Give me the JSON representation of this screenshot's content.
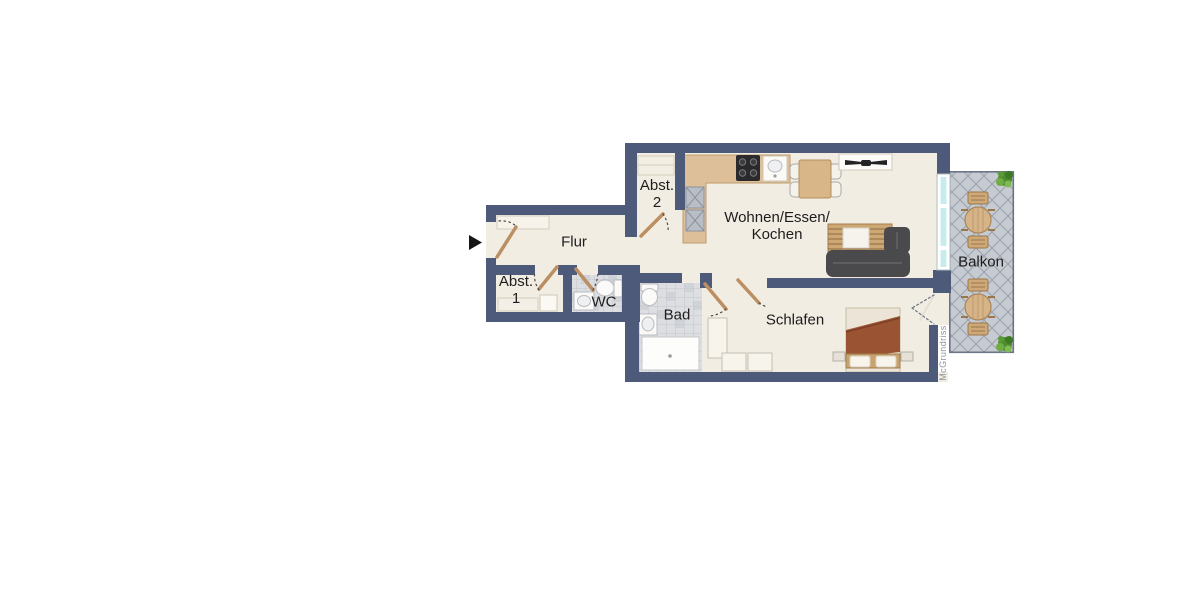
{
  "plan": {
    "rooms": {
      "flur": {
        "label": "Flur"
      },
      "abst1": {
        "label_line1": "Abst.",
        "label_line2": "1"
      },
      "abst2": {
        "label_line1": "Abst.",
        "label_line2": "2"
      },
      "wc": {
        "label": "WC"
      },
      "bad": {
        "label": "Bad"
      },
      "wohnen": {
        "label_line1": "Wohnen/Essen/",
        "label_line2": "Kochen"
      },
      "schlafen": {
        "label": "Schlafen"
      },
      "balkon": {
        "label": "Balkon"
      }
    },
    "watermark": "McGrundriss",
    "colors": {
      "wall": "#4d5a7a",
      "floor": "#f2ede3",
      "tile": "#dcdee1",
      "balcony_tile": "#c6cad1",
      "counter": "#ddbf9a",
      "door_leaf": "#bb8f62",
      "window_glass": "#c8ecee",
      "sofa": "#4a4a4c",
      "bed_blanket": "#9a5434",
      "plant": "#4f8d2e"
    }
  }
}
